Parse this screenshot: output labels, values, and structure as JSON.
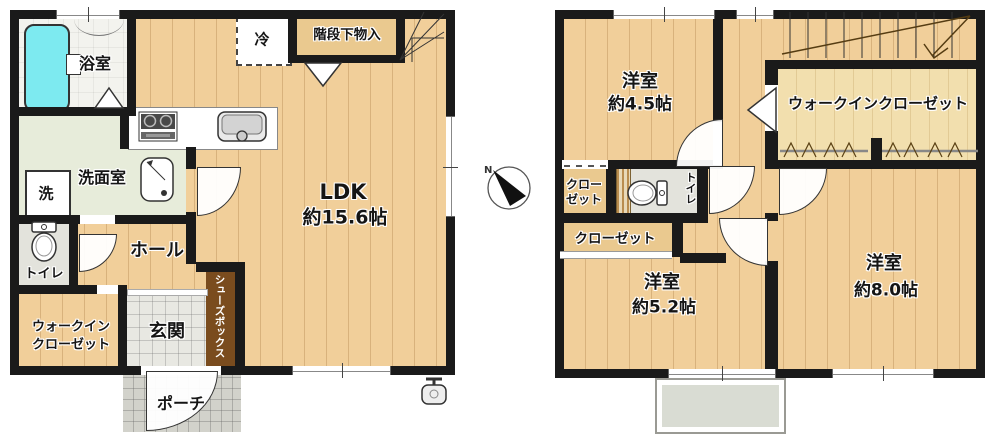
{
  "compass": {
    "north_label": "N"
  },
  "floor1": {
    "bath": "浴室",
    "washroom": "洗面室",
    "washer": "洗",
    "fridge": "冷",
    "under_stair_storage": "階段下物入",
    "ldk_name": "LDK",
    "ldk_size": "約15.6帖",
    "toilet": "トイレ",
    "hall": "ホール",
    "walkin_closet_line1": "ウォークイン",
    "walkin_closet_line2": "クローゼット",
    "entrance": "玄関",
    "shoe_box": "シューズボックス",
    "porch": "ポーチ"
  },
  "floor2": {
    "bedroom_small_name": "洋室",
    "bedroom_small_size": "約4.5帖",
    "walkin_closet": "ウォークインクローゼット",
    "closet_upper_line1": "クロー",
    "closet_upper_line2": "ゼット",
    "toilet": "トイレ",
    "closet_lower": "クローゼット",
    "bedroom_mid_name": "洋室",
    "bedroom_mid_size": "約5.2帖",
    "bedroom_large_name": "洋室",
    "bedroom_large_size": "約8.0帖"
  },
  "colors": {
    "wall": "#1a1a1a",
    "wood_floor": "#f1cf9a",
    "closet_floor": "#f2dfae",
    "bathtub": "#7deaf0",
    "washroom_floor": "#e7ecda",
    "tile_gray": "#d2d2cb",
    "shoe_box_brown": "#7a4c1e"
  }
}
